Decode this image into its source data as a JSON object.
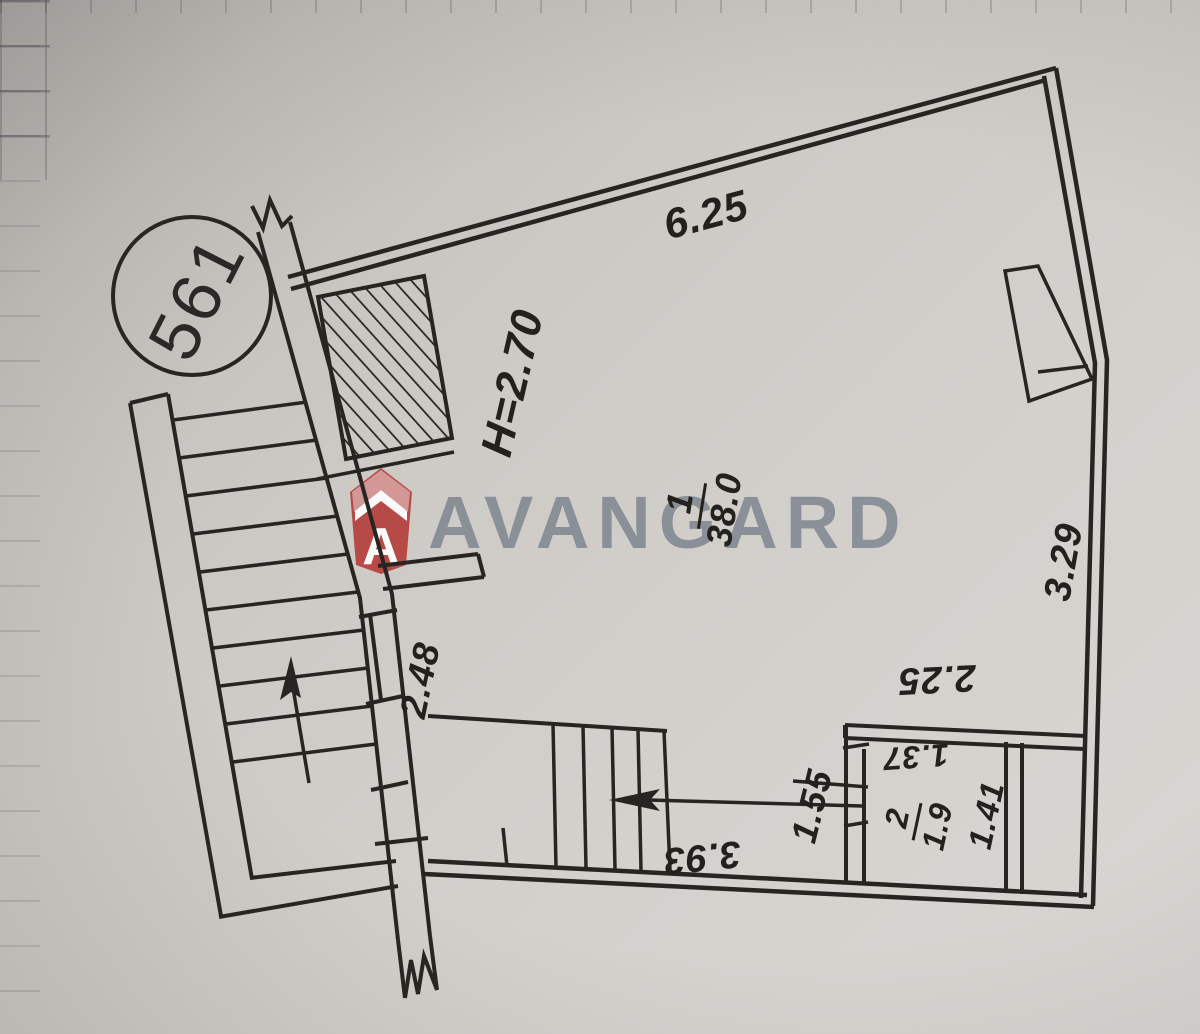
{
  "plan": {
    "unit_number": "561",
    "watermark": {
      "brand": "AVANGARD",
      "letter_a": "A",
      "red": "#b5403d",
      "gray": "#7b8290"
    },
    "room_main": {
      "number": "1",
      "area": "38.0",
      "ceiling_height": "H=2.70"
    },
    "room_small": {
      "number": "2",
      "area": "1.9"
    },
    "dimensions": {
      "top_wall": "6.25",
      "right_wall": "3.29",
      "entry_wall": "2.48",
      "bottom_wall": "3.93",
      "room_small_top": "2.25",
      "room_small_left": "1.55",
      "room_small_width": "1.37",
      "room_small_depth": "1.41"
    },
    "colors": {
      "ink": "#262522",
      "paper": "#cfccc7"
    }
  }
}
